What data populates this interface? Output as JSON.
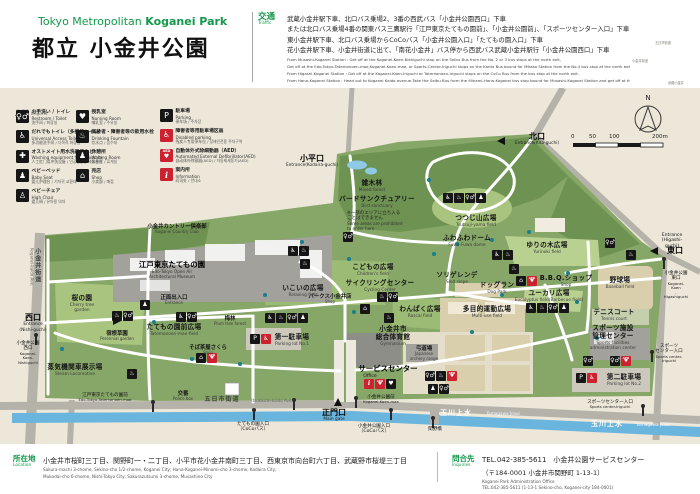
{
  "header": {
    "title_en_regular": "Tokyo Metropolitan ",
    "title_en_bold": "Koganei Park",
    "title_ja": "都立 小金井公園",
    "accent_green": "#12994a"
  },
  "traffic": {
    "label_ja": "交通",
    "label_en": "Traffic",
    "lines_ja": [
      "武蔵小金井駅下車、北口バス乗場2、3番の西武バス「小金井公園西口」下車",
      "または北口バス乗場4番の関東バス三鷹駅行「江戸東京たてもの園前」、「小金井公園前」、「スポーツセンター入口」下車",
      "東小金井駅下車、北口バス乗場からCoCoバス「小金井公園入口」「たてもの園入口」下車",
      "花小金井駅下車、小金井街道に出て、「南花小金井」バス停から西武バス武蔵小金井駅行「小金井公園西口」下車"
    ],
    "lines_en": [
      "From Musashi-Koganei Station : Get off at the Koganei-Koen-Nishiguchi stop on the Seibu Bus from the No. 2 or 3 bus stops at the north exit,",
      "Get off at the Edo-Tokyo-Tatemonoen-mae,Koganei-Koen-mae, or Sports-Center-Iriguchi stops on the Kanto Bus bound for Mitaka Station from the No.4 bus stop at the north exit. of Musashi-Koganei Station.",
      "From Higashi-Koganei Station : Get off at the Koganei-Koen-Iriguchi or Tatemonoen-Iriguchi stops on the CoCo Bus from the bus stop at the north exit.",
      "From Hana-Koganei Station : Head out to Koganei Kaido avenue.Take the Seibu Bus from the Minami-Hana-Koganei bus stop bound for Musashi-Koganei Station and get off at the Koganei-Koen-Nishiguchi stop."
    ]
  },
  "legend": {
    "title_ja": "凡例",
    "title_en": "Legend",
    "cols": [
      {
        "items": [
          {
            "icon": "toilet",
            "ja": "お手洗い / トイレ",
            "en": "Restroom / Toilet",
            "ot": "洗手间 / 화장실"
          },
          {
            "icon": "wheelchair",
            "ja": "だれでもトイレ（多機能トイレ）",
            "en": "Universal Access Toilet",
            "ot": "多功能洗手间 / 다목적 화장실"
          },
          {
            "icon": "ostomate",
            "ja": "オストメイト用水洗器具など",
            "en": "Washing equipment for Ostomate",
            "ot": "人工肛门用冲洗设备 / 인공항문용 세정설비"
          },
          {
            "icon": "baby-bed",
            "ja": "ベビーベッド",
            "en": "Baby Seat",
            "ot": "婴儿护理台 / 기저귀 교환대"
          },
          {
            "icon": "high-chair",
            "ja": "ベビーチェア",
            "en": "High Chair",
            "ot": "婴儿椅 / 유아용 의자"
          }
        ]
      },
      {
        "items": [
          {
            "icon": "nursing",
            "ja": "授乳室",
            "en": "Nursing Room",
            "ot": "哺乳室 / 수유실"
          },
          {
            "icon": "drinking",
            "ja": "高齢者・障害者等の飲用水栓",
            "en": "Drinking Fountain",
            "ot": "饮水点 / 음수대"
          },
          {
            "icon": "waiting",
            "ja": "休憩所",
            "en": "Waiting Room",
            "ot": "休息室 / 휴게실"
          },
          {
            "icon": "shop",
            "ja": "売店",
            "en": "Shop",
            "ot": "小卖部 / 매점"
          }
        ]
      },
      {
        "items": [
          {
            "icon": "parking",
            "ja": "駐車場",
            "en": "Parking",
            "ot": "停车场 / 주차장"
          },
          {
            "icon": "disabled-parking",
            "ja": "障害者等用駐車場区画",
            "en": "Disabled parking",
            "ot": "残疾人专用停车位 / 장애인전용 주차구역"
          },
          {
            "icon": "aed",
            "ja": "自動体外式除細動器（AED）",
            "en": "Automated External Defibrillator(AED)",
            "ot": "自动体外除颤器(AED) / 자동제세동기(AED)"
          },
          {
            "icon": "info",
            "ja": "案内所",
            "en": "Information",
            "ot": "问讯处 / 안내소"
          }
        ]
      }
    ]
  },
  "map": {
    "compass": "N",
    "scale_ticks": [
      {
        "t": "0",
        "x": 571
      },
      {
        "t": "50",
        "x": 589
      },
      {
        "t": "100",
        "x": 609
      },
      {
        "t": "200m",
        "x": 652
      }
    ],
    "labels": [
      {
        "x": 177,
        "y": 224,
        "cls": "area-sm",
        "name": "label-koganei-country-club",
        "ja": "小金井カントリー倶楽部",
        "en": "Koganei Country Club"
      },
      {
        "x": 29,
        "y": 248,
        "cls": "road vert la",
        "name": "label-koganei-kaido",
        "ja": "小金井街道",
        "en": "Koganei-kaido Ave."
      },
      {
        "x": 33,
        "y": 313,
        "cls": "ent",
        "name": "label-entrance-nishiguchi",
        "ja": "西口",
        "en": "Entrance\n(Nishi-guchi)"
      },
      {
        "x": 28,
        "y": 341,
        "cls": "bus",
        "name": "busstop-koganei-koen-nishiguchi",
        "ja": "小金井公園\n西口",
        "en": "Koganei-\nKoen-\nNishiguchi"
      },
      {
        "x": 312,
        "y": 154,
        "cls": "ent",
        "name": "label-entrance-kodaira-guchi",
        "ja": "小平口",
        "en": "Entrance(Kodaira-guchi)"
      },
      {
        "x": 537,
        "y": 132,
        "cls": "ent",
        "name": "label-entrance-kita-guchi",
        "ja": "北口",
        "en": "Entrance(Kita-guchi)"
      },
      {
        "x": 672,
        "y": 233,
        "cls": "bus",
        "name": "label-entrance-higashi-en",
        "ja": "Entrance\n(Higashi-guchi)"
      },
      {
        "x": 675,
        "y": 246,
        "cls": "ent",
        "name": "label-entrance-higashi-guchi",
        "ja": "東口"
      },
      {
        "x": 676,
        "y": 271,
        "cls": "bus",
        "name": "busstop-koganei-koen-higashiguchi",
        "ja": "小金井公園\n東口",
        "en": "Koganei-Koen\n-Higashiguchi"
      },
      {
        "x": 334,
        "y": 408,
        "cls": "ent",
        "name": "label-main-gate",
        "ja": "正門口",
        "en": "Main gate"
      },
      {
        "x": 381,
        "y": 395,
        "cls": "bus",
        "name": "busstop-koganei-koen-mae",
        "ja": "小金井公園前",
        "en": "Koganei-Koen-mae"
      },
      {
        "x": 374,
        "y": 424,
        "cls": "bus",
        "name": "busstop-koganei-koen-iriguchi",
        "ja": "小金井公園入口\n（CoCoバス）"
      },
      {
        "x": 435,
        "y": 427,
        "cls": "bus",
        "name": "busstop-sekino-bashi",
        "ja": "関野橋"
      },
      {
        "x": 253,
        "y": 422,
        "cls": "bus",
        "name": "busstop-tatemonoen-iriguchi",
        "ja": "たてもの園入口\n（CoCoバス）"
      },
      {
        "x": 105,
        "y": 393,
        "cls": "bus",
        "name": "busstop-edo-tokyo-tatemonoen-mae",
        "ja": "江戸東京たてもの園前",
        "en": "Edo-Tokyo-Tatemonoen-mae"
      },
      {
        "x": 183,
        "y": 391,
        "cls": "area-sm",
        "name": "label-police-box",
        "ja": "交番",
        "en": "Police box"
      },
      {
        "x": 222,
        "y": 396,
        "cls": "road",
        "name": "label-itsukaichi-kaido-ja",
        "ja": "五日市街道"
      },
      {
        "x": 272,
        "y": 399,
        "cls": "road-en",
        "name": "label-itsukaichi-kaido-en",
        "ja": "Itsukaichi-kaido Ave."
      },
      {
        "x": 456,
        "y": 409,
        "cls": "water",
        "name": "label-tamagawa-josui-ja-1",
        "ja": "玉川上水"
      },
      {
        "x": 503,
        "y": 412,
        "cls": "water-en",
        "name": "label-tamagawa-josui-en-1",
        "ja": "Tamagawa Josui"
      },
      {
        "x": 607,
        "y": 420,
        "cls": "water",
        "name": "label-tamagawa-josui-ja-2",
        "ja": "玉川上水"
      },
      {
        "x": 653,
        "y": 423,
        "cls": "water-en",
        "name": "label-tamagawa-josui-en-2",
        "ja": "Tamagawa Josui"
      },
      {
        "x": 372,
        "y": 180,
        "cls": "area",
        "name": "label-mixed-forest",
        "ja": "雑木林",
        "en": "Mixed forest"
      },
      {
        "x": 377,
        "y": 196,
        "cls": "area",
        "name": "label-bird-sanctuary",
        "ja": "バードサンクチュアリー",
        "en": "Bird sanctuary"
      },
      {
        "x": 347,
        "y": 211,
        "cls": "note la",
        "name": "label-prohibited-note",
        "ja": "※一部のエリアに立ち入る\nことはできません",
        "en": "Some areas are prohibited\nto enter here"
      },
      {
        "x": 476,
        "y": 215,
        "cls": "area",
        "name": "label-tsutsuji-yama-field",
        "ja": "つつじ山広場",
        "en": "Tsutsuji-yama field"
      },
      {
        "x": 467,
        "y": 235,
        "cls": "area",
        "name": "label-fuwa-fuwa-dome",
        "ja": "ふわふわドーム",
        "en": "Fuwa-Fuwa dome"
      },
      {
        "x": 547,
        "y": 242,
        "cls": "area",
        "name": "label-yurinoki-field",
        "ja": "ゆりの木広場",
        "en": "Yurinoki field"
      },
      {
        "x": 373,
        "y": 264,
        "cls": "area",
        "name": "label-childrens-field",
        "ja": "こどもの広場",
        "en": "Children's field"
      },
      {
        "x": 380,
        "y": 280,
        "cls": "area",
        "name": "label-cycling-center",
        "ja": "サイクリングセンター",
        "en": "Cycling Center"
      },
      {
        "x": 330,
        "y": 294,
        "cls": "area-sm",
        "name": "label-parks-koganei-shop",
        "ja": "パークス小金井店",
        "en": "Shop"
      },
      {
        "x": 303,
        "y": 285,
        "cls": "area",
        "name": "label-relaxing-field",
        "ja": "いこいの広場",
        "en": "Relaxing field"
      },
      {
        "x": 457,
        "y": 272,
        "cls": "area",
        "name": "label-sled-slope",
        "ja": "ソリゲレンデ",
        "en": "Sled slope"
      },
      {
        "x": 497,
        "y": 282,
        "cls": "area",
        "name": "label-dog-park",
        "ja": "ドッグラン",
        "en": "Dog Park"
      },
      {
        "x": 420,
        "y": 306,
        "cls": "area",
        "name": "label-rascal-field",
        "ja": "わんぱく広場",
        "en": "Rascal field"
      },
      {
        "x": 487,
        "y": 306,
        "cls": "area",
        "name": "label-multi-use-field",
        "ja": "多目的運動広場",
        "en": "Multi-use field"
      },
      {
        "x": 566,
        "y": 275,
        "cls": "area",
        "name": "label-bbq-shop",
        "ja": "B.B.Q.ショップ",
        "en": "Shop"
      },
      {
        "x": 549,
        "y": 290,
        "cls": "area",
        "name": "label-eucalyptus-field",
        "ja": "ユーカリ広場",
        "en": "Eucalyptus field(Barbecue field)"
      },
      {
        "x": 620,
        "y": 277,
        "cls": "area",
        "name": "label-baseball-field",
        "ja": "野球場",
        "en": "Baseball field"
      },
      {
        "x": 614,
        "y": 309,
        "cls": "area",
        "name": "label-tennis-court",
        "ja": "テニスコート",
        "en": "Tennis court"
      },
      {
        "x": 613,
        "y": 325,
        "cls": "area",
        "name": "label-sports-admin-center",
        "ja": "スポーツ施設\n管理センター",
        "en": "Sports facilities\nadministration center"
      },
      {
        "x": 624,
        "y": 374,
        "cls": "area",
        "name": "label-parking-lot-2",
        "ja": "第二駐車場",
        "en": "Parking lot No.2"
      },
      {
        "x": 669,
        "y": 344,
        "cls": "bus",
        "name": "busstop-sports-center-iriguchi-east",
        "ja": "スポーツ\nセンター入口",
        "en": "Sports center-\nIriguchi"
      },
      {
        "x": 610,
        "y": 400,
        "cls": "bus",
        "name": "busstop-sports-center-iriguchi-south",
        "ja": "スポーツセンター入口",
        "en": "Sports center-Iriguchi"
      },
      {
        "x": 82,
        "y": 295,
        "cls": "area",
        "name": "label-cherry-tree-garden",
        "ja": "桜の園",
        "en": "Cherry tree\ngarden"
      },
      {
        "x": 117,
        "y": 331,
        "cls": "area-sm",
        "name": "label-perennial-garden",
        "ja": "宿根草園",
        "en": "Perennial garden"
      },
      {
        "x": 75,
        "y": 364,
        "cls": "area",
        "name": "label-steam-locomotive",
        "ja": "蒸気機関車展示場",
        "en": "Steam Locomotive"
      },
      {
        "x": 172,
        "y": 261,
        "cls": "area-lg",
        "name": "label-edo-tokyo-museum",
        "ja": "江戸東京たてもの園",
        "en": "Edo-Tokyo Open Air\nArchitectural Museum"
      },
      {
        "x": 174,
        "y": 295,
        "cls": "area-sm",
        "name": "label-museum-entrance",
        "ja": "正面出入口",
        "en": "Entrance"
      },
      {
        "x": 174,
        "y": 324,
        "cls": "area",
        "name": "label-tatemonoen-mae-field",
        "ja": "たてもの園前広場",
        "en": "Tatemonoen-mae-field"
      },
      {
        "x": 230,
        "y": 316,
        "cls": "area-sm",
        "name": "label-plum-tree-forest",
        "ja": "梅林",
        "en": "Plum tree forest"
      },
      {
        "x": 208,
        "y": 345,
        "cls": "area-sm",
        "name": "label-soba-chaya-sakura",
        "ja": "そば茶屋さくら",
        "en": "Shop"
      },
      {
        "x": 292,
        "y": 334,
        "cls": "area",
        "name": "label-parking-lot-1",
        "ja": "第一駐車場",
        "en": "Parking lot No.1"
      },
      {
        "x": 393,
        "y": 326,
        "cls": "area",
        "name": "label-gymnasium",
        "ja": "小金井市\n総合体育館",
        "en": "Gymnasium"
      },
      {
        "x": 424,
        "y": 346,
        "cls": "area-sm",
        "name": "label-archery-range",
        "ja": "弓道場",
        "en": "Japanese\narchery range"
      },
      {
        "x": 388,
        "y": 365,
        "cls": "area-lg",
        "name": "label-service-center",
        "ja": "サービスセンター"
      },
      {
        "x": 370,
        "y": 374,
        "cls": "bus",
        "name": "label-service-center-office",
        "ja": "Office"
      }
    ],
    "icon_clusters": [
      {
        "x": 343,
        "y": 232,
        "icons": [
          "toilet"
        ]
      },
      {
        "x": 443,
        "y": 193,
        "icons": [
          "wheelchair",
          "drinking",
          "toilet",
          "waiting"
        ]
      },
      {
        "x": 492,
        "y": 250,
        "icons": [
          "wheelchair",
          "drinking"
        ]
      },
      {
        "x": 509,
        "y": 264,
        "icons": [
          "drinking"
        ]
      },
      {
        "x": 516,
        "y": 276,
        "icons": [
          "shop",
          "aed"
        ]
      },
      {
        "x": 526,
        "y": 303,
        "icons": [
          "wheelchair",
          "drinking",
          "toilet",
          "waiting"
        ]
      },
      {
        "x": 583,
        "y": 356,
        "icons": [
          "toilet"
        ]
      },
      {
        "x": 610,
        "y": 356,
        "icons": [
          "toilet",
          "aed"
        ]
      },
      {
        "x": 576,
        "y": 373,
        "icons": [
          "parking",
          "disabled-parking"
        ]
      },
      {
        "x": 250,
        "y": 334,
        "icons": [
          "parking",
          "disabled-parking"
        ]
      },
      {
        "x": 364,
        "y": 379,
        "icons": [
          "info",
          "aed",
          "nursing"
        ]
      },
      {
        "x": 425,
        "y": 371,
        "icons": [
          "toilet",
          "drinking",
          "aed"
        ]
      },
      {
        "x": 428,
        "y": 384,
        "icons": [
          "waiting",
          "toilet"
        ]
      },
      {
        "x": 196,
        "y": 353,
        "icons": [
          "shop",
          "aed"
        ]
      },
      {
        "x": 140,
        "y": 300,
        "icons": [
          "waiting"
        ]
      },
      {
        "x": 176,
        "y": 312,
        "icons": [
          "wheelchair",
          "toilet"
        ]
      },
      {
        "x": 265,
        "y": 313,
        "icons": [
          "wheelchair",
          "drinking",
          "toilet",
          "waiting"
        ]
      },
      {
        "x": 288,
        "y": 246,
        "icons": [
          "wheelchair",
          "drinking"
        ]
      },
      {
        "x": 300,
        "y": 259,
        "icons": [
          "drinking"
        ]
      },
      {
        "x": 360,
        "y": 304,
        "icons": [
          "shop"
        ]
      },
      {
        "x": 377,
        "y": 292,
        "icons": [
          "drinking",
          "toilet"
        ]
      },
      {
        "x": 384,
        "y": 313,
        "icons": [
          "drinking"
        ]
      },
      {
        "x": 605,
        "y": 238,
        "icons": [
          "toilet"
        ]
      },
      {
        "x": 626,
        "y": 250,
        "icons": [
          "drinking"
        ]
      },
      {
        "x": 112,
        "y": 311,
        "icons": [
          "drinking",
          "toilet"
        ]
      },
      {
        "x": 127,
        "y": 369,
        "icons": [
          "drinking"
        ]
      }
    ],
    "poles": [
      [
        35,
        336
      ],
      [
        152,
        403
      ],
      [
        253,
        411
      ],
      [
        355,
        399
      ],
      [
        390,
        411
      ],
      [
        432,
        419
      ],
      [
        293,
        401
      ],
      [
        651,
        353
      ],
      [
        642,
        407
      ],
      [
        663,
        260
      ]
    ],
    "markers": [
      {
        "x": 497,
        "y": 137,
        "dir": "left",
        "name": "gate-marker-kita"
      },
      {
        "x": 113,
        "y": 317,
        "dir": "right",
        "name": "gate-marker-nishi"
      },
      {
        "x": 650,
        "y": 247,
        "dir": "left",
        "name": "gate-marker-higashi"
      },
      {
        "x": 334,
        "y": 398,
        "dir": "up",
        "name": "gate-marker-main"
      }
    ],
    "dots": [
      [
        300,
        240
      ],
      [
        347,
        257
      ],
      [
        427,
        178
      ],
      [
        455,
        242
      ],
      [
        490,
        238
      ],
      [
        527,
        230
      ],
      [
        575,
        300
      ],
      [
        470,
        330
      ],
      [
        263,
        293
      ],
      [
        152,
        320
      ],
      [
        190,
        357
      ],
      [
        60,
        347
      ],
      [
        595,
        336
      ],
      [
        352,
        310
      ],
      [
        432,
        252
      ],
      [
        500,
        293
      ],
      [
        566,
        271
      ],
      [
        238,
        362
      ]
    ],
    "minimap_labels": [
      {
        "x": 655,
        "y": 40,
        "t": "五日市街道"
      },
      {
        "x": 632,
        "y": 58,
        "t": "小金井街道"
      },
      {
        "x": 668,
        "y": 80,
        "t": "武蔵小金井"
      }
    ]
  },
  "footer": {
    "location_label_ja": "所在地",
    "location_label_en": "Location",
    "location_ja": "小金井市桜町三丁目、関野町一・二丁目、小平市花小金井南町三丁目、西東京市向台町六丁目、武蔵野市桜堤三丁目",
    "location_en1": "Sakura-machi 3-chome, Sekino-cho 1/2-chome, Koganei City; Hana-Koganei-Minami-cho 3-chome, Kodaira City;",
    "location_en2": "Mukodai-cho 6-chome, Nishi-Tokyo City; Sakurazutsumi 3-chome, Musashino City",
    "inquiries_label_ja": "問合先",
    "inquiries_label_en": "Inquiries",
    "inq_line1": "TEL.042-385-5611　小金井公園サービスセンター",
    "inq_line2": "（〒184-0001 小金井市関野町 1-13-1）",
    "inq_en1": "Koganei Park Administration Office",
    "inq_en2": "TEL.042-385-5611 (1-13-1 Sekino-cho, Koganei-city 184-0001)"
  },
  "colors": {
    "park_green": "#87a768",
    "woods_green": "#6e9251",
    "field_light": "#b9d190",
    "water_blue": "#69b5dd",
    "road_gray": "#b5b2aa",
    "bg_beige": "#ece7d9",
    "aed_red": "#cc2230"
  }
}
